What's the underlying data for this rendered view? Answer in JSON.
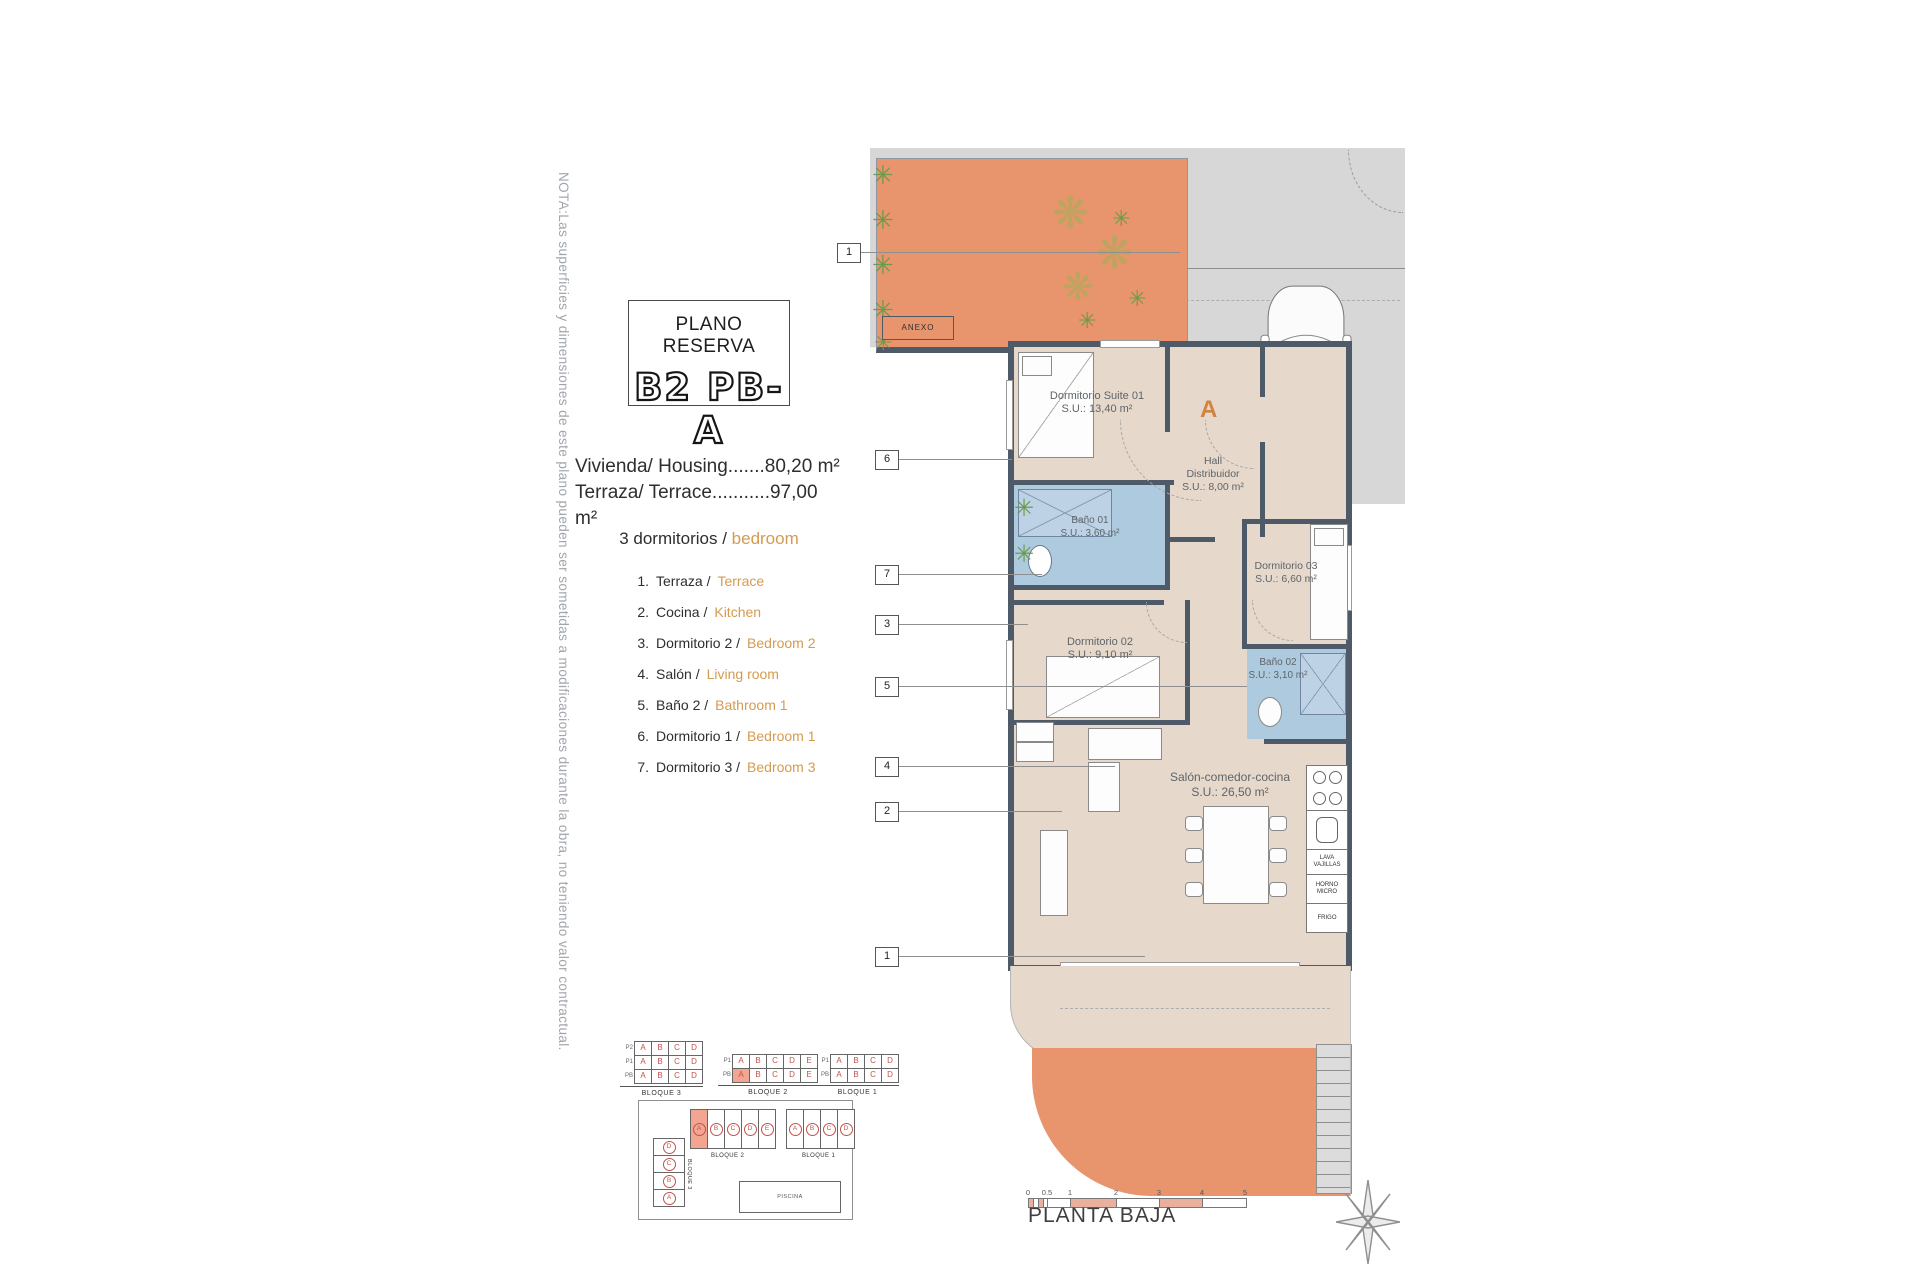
{
  "note": "NOTA:Las superficies y dimensiones de este plano pueden ser sometidas a modificaciones durante la obra, no teniendo valor contractual.",
  "title": {
    "heading": "PLANO RESERVA",
    "code": "B2 PB-A"
  },
  "areas": {
    "housing": "Vivienda/ Housing.......80,20 m²",
    "terrace": "Terraza/ Terrace...........97,00 m²"
  },
  "bedrooms": {
    "es": "3 dormitorios /",
    "en": "bedroom"
  },
  "legend": {
    "items": [
      {
        "num": "1.",
        "es": "Terraza /",
        "en": "Terrace"
      },
      {
        "num": "2.",
        "es": "Cocina /",
        "en": "Kitchen"
      },
      {
        "num": "3.",
        "es": "Dormitorio 2 /",
        "en": "Bedroom 2"
      },
      {
        "num": "4.",
        "es": "Salón /",
        "en": "Living room"
      },
      {
        "num": "5.",
        "es": "Baño 2 /",
        "en": "Bathroom 1"
      },
      {
        "num": "6.",
        "es": "Dormitorio 1 /",
        "en": "Bedroom 1"
      },
      {
        "num": "7.",
        "es": "Dormitorio 3 /",
        "en": "Bedroom 3"
      }
    ]
  },
  "plan": {
    "entrance_letter": "A",
    "annex": "ANEXO",
    "rooms": {
      "suite": {
        "name": "Dormitorio Suite 01",
        "area": "S.U.: 13,40 m²"
      },
      "hall": {
        "name": "Hall",
        "name2": "Distribuidor",
        "area": "S.U.: 8,00 m²"
      },
      "bano1": {
        "name": "Baño 01",
        "area": "S.U.: 3,60 m²"
      },
      "dorm3": {
        "name": "Dormitorio 03",
        "area": "S.U.: 6,60 m²"
      },
      "dorm2": {
        "name": "Dormitorio 02",
        "area": "S.U.: 9,10 m²"
      },
      "bano2": {
        "name": "Baño 02",
        "area": "S.U.: 3,10 m²"
      },
      "salon": {
        "name": "Salón-comedor-cocina",
        "area": "S.U.: 26,50 m²"
      }
    },
    "appliances": {
      "dishwasher_l1": "LAVA",
      "dishwasher_l2": "VAJILLAS",
      "oven_l1": "HORNO",
      "oven_l2": "MICRO",
      "fridge": "FRIGO"
    },
    "markers": [
      "1",
      "6",
      "7",
      "3",
      "5",
      "4",
      "2",
      "1"
    ]
  },
  "blocks": {
    "b3": {
      "label": "BLOQUE 3",
      "row_labels": [
        "P2",
        "P1",
        "PB"
      ],
      "rows": [
        [
          "A",
          "B",
          "C",
          "D"
        ],
        [
          "A",
          "B",
          "C",
          "D"
        ],
        [
          "A",
          "B",
          "C",
          "D"
        ]
      ]
    },
    "b2": {
      "label": "BLOQUE 2",
      "row_labels": [
        "P1",
        "PB"
      ],
      "rows": [
        [
          "A",
          "B",
          "C",
          "D",
          "E"
        ],
        [
          "A",
          "B",
          "C",
          "D",
          "E"
        ]
      ]
    },
    "b1": {
      "label": "BLOQUE 1",
      "row_labels": [
        "P1",
        "PB"
      ],
      "rows": [
        [
          "A",
          "B",
          "C",
          "D"
        ],
        [
          "A",
          "B",
          "C",
          "D"
        ]
      ]
    }
  },
  "siteplan": {
    "bloque2": {
      "label": "BLOQUE 2",
      "units": [
        "A",
        "B",
        "C",
        "D",
        "E"
      ]
    },
    "bloque1": {
      "label": "BLOQUE 1",
      "units": [
        "A",
        "B",
        "C",
        "D"
      ]
    },
    "bloque3": {
      "label": "BLOQUE 3",
      "units": [
        "D",
        "C",
        "B",
        "A"
      ]
    },
    "pool": "PISCINA"
  },
  "scalebar": {
    "ticks": [
      "0",
      "0.5",
      "1",
      "2",
      "3",
      "4",
      "5"
    ]
  },
  "footer": {
    "floor_label": "PLANTA BAJA"
  },
  "colors": {
    "terrace_orange": "#E8946C",
    "floor_beige": "#E6D8CB",
    "wall_dark": "#4E5A68",
    "parcel_grey": "#D7D7D7",
    "bath_blue": "#AECADF",
    "accent_orange": "#D49B51",
    "unit_red": "#C3524A",
    "highlight_salmon": "#F2A692"
  }
}
